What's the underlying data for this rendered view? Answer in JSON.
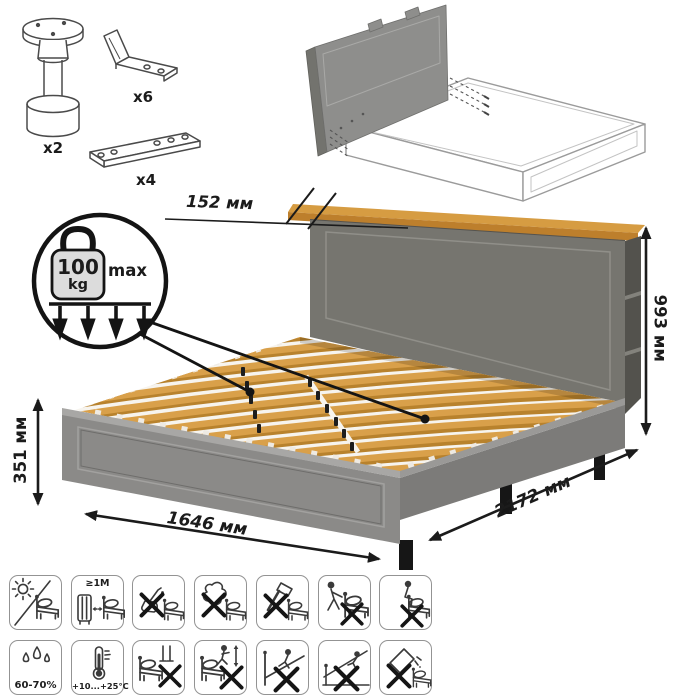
{
  "hardware": {
    "leg": {
      "label": "x2"
    },
    "bracket": {
      "label": "x6"
    },
    "plate": {
      "label": "x4"
    }
  },
  "dimensions": {
    "shelf_depth": "152 мм",
    "total_height": "993 мм",
    "frame_height": "351 мм",
    "width": "1646 мм",
    "length": "2172 мм"
  },
  "load": {
    "value": "100",
    "unit": "kg",
    "qualifier": "max"
  },
  "icons": {
    "row1": [
      {
        "name": "avoid-direct-sunlight"
      },
      {
        "name": "keep-distance-from-heat",
        "label": "≥1М"
      },
      {
        "name": "no-liquids"
      },
      {
        "name": "no-aggressive-cleaning"
      },
      {
        "name": "no-hammering"
      },
      {
        "name": "no-dragging"
      },
      {
        "name": "no-sitting-on-edge"
      }
    ],
    "row2": [
      {
        "name": "humidity-range",
        "label": "60-70%"
      },
      {
        "name": "temperature-range",
        "label": "+10...+25°C"
      },
      {
        "name": "no-standing-on-bed"
      },
      {
        "name": "no-jumping-on-bed"
      },
      {
        "name": "no-climbing"
      },
      {
        "name": "no-sliding"
      },
      {
        "name": "no-tipping-panels"
      }
    ]
  },
  "colors": {
    "bed_grey": "#8b8a88",
    "headboard_grey": "#76756f",
    "wood": "#d69c42",
    "line": "#1b1b1b"
  }
}
